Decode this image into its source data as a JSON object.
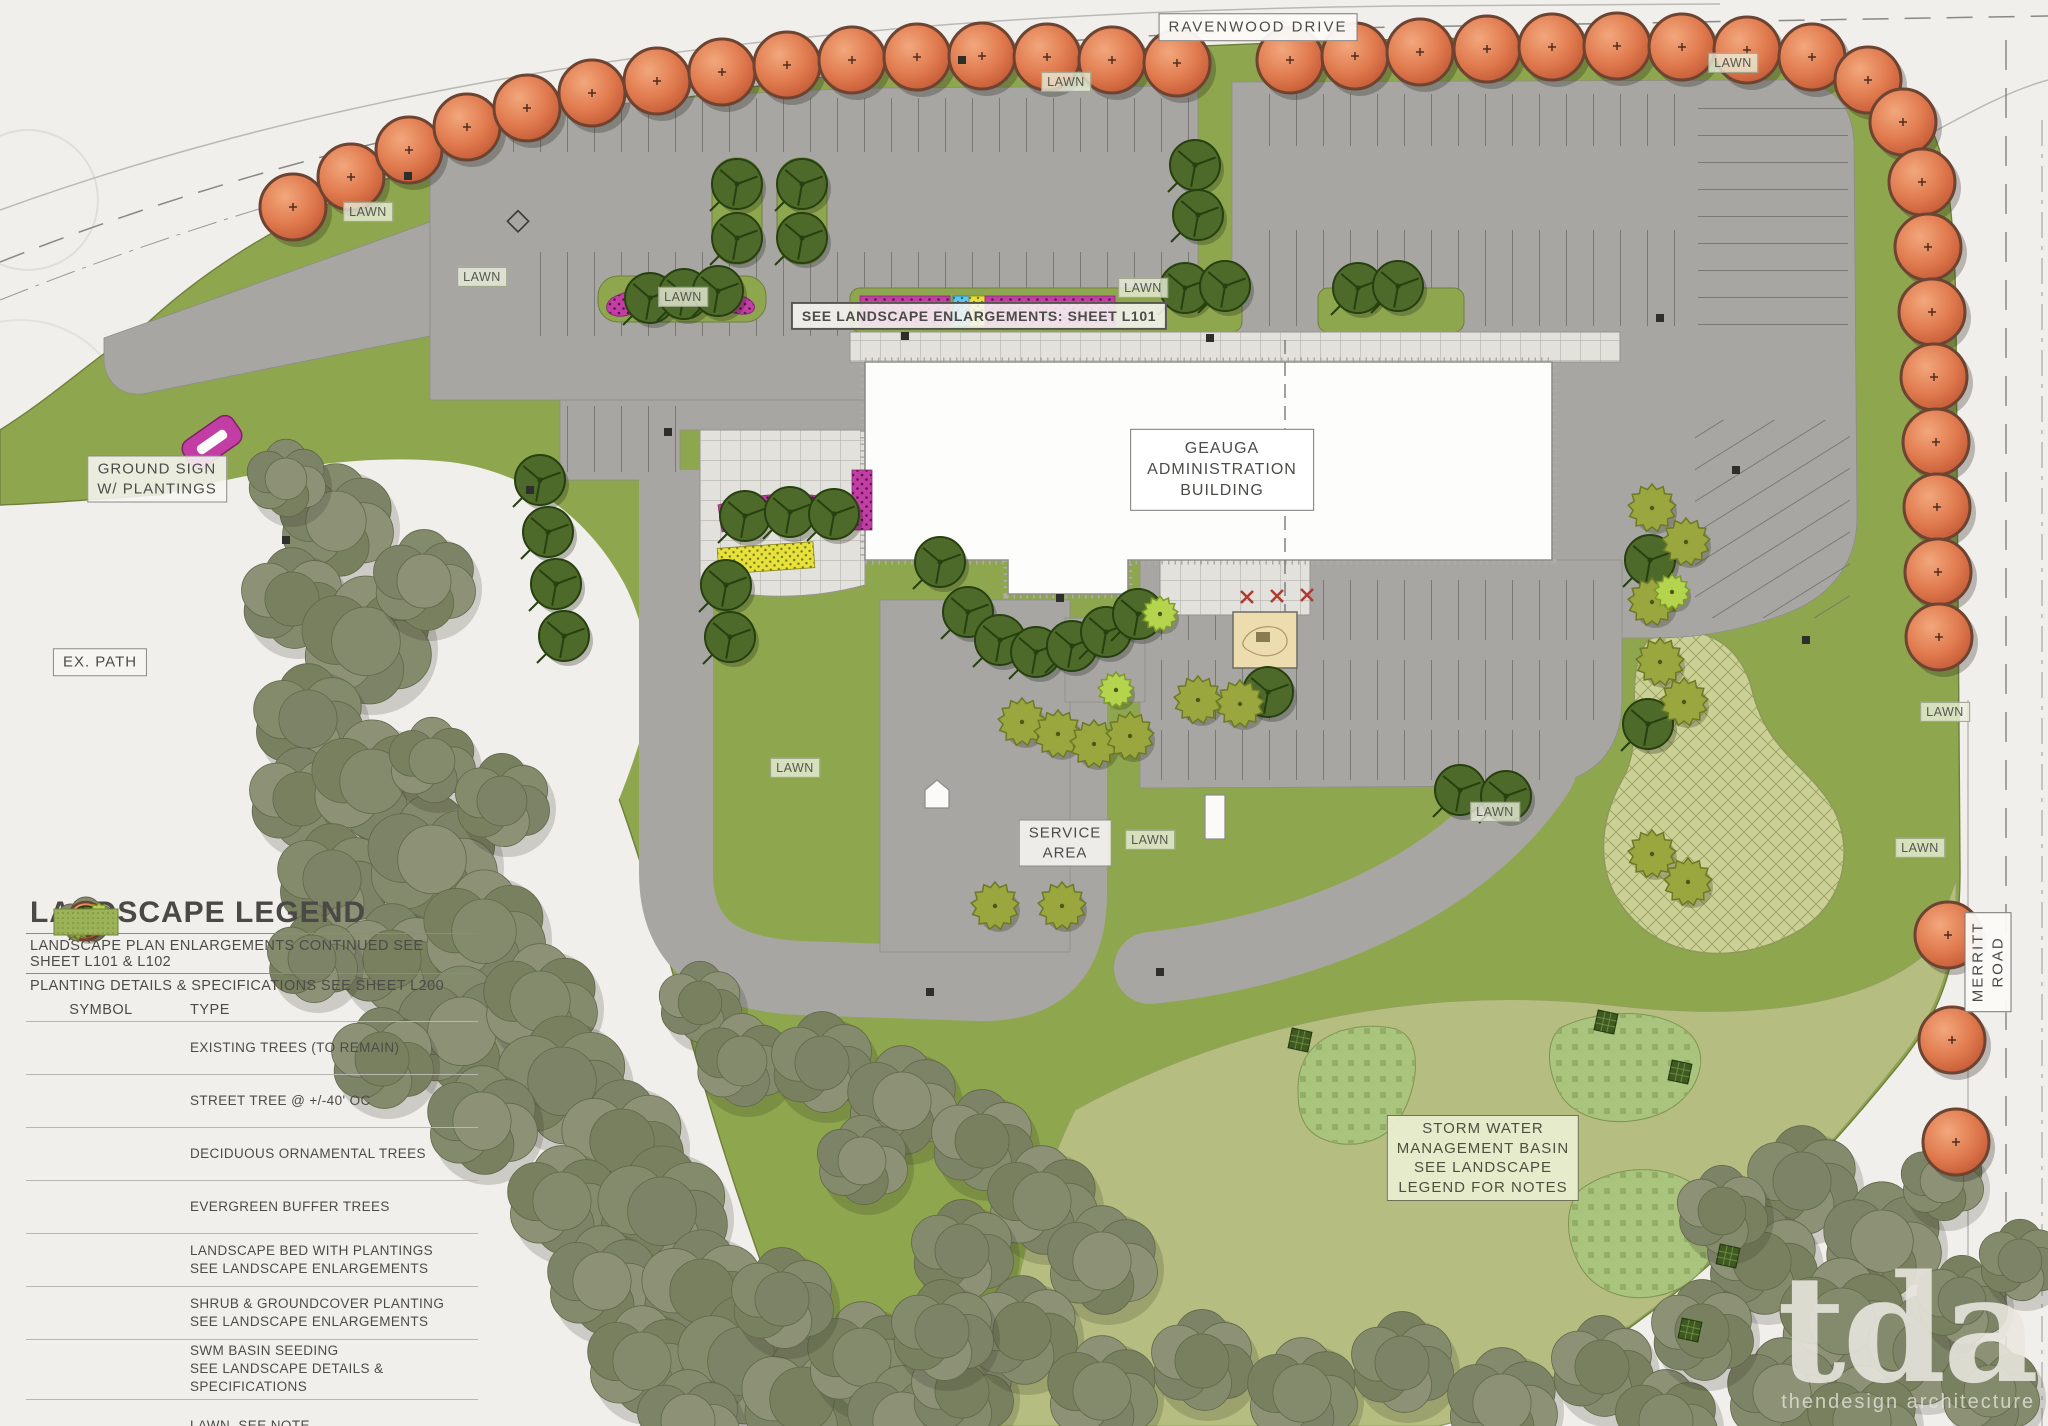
{
  "plan": {
    "roads": {
      "top": "RAVENWOOD DRIVE",
      "right": "MERRITT ROAD"
    },
    "labels": [
      {
        "text": "RAVENWOOD DRIVE",
        "x": 1258,
        "y": 27,
        "cls": "road"
      },
      {
        "text": "MERRITT ROAD",
        "x": 1988,
        "y": 962,
        "cls": "road",
        "rot": -90
      },
      {
        "text": "GROUND SIGN\nW/ PLANTINGS",
        "x": 157,
        "y": 479,
        "cls": ""
      },
      {
        "text": "EX. PATH",
        "x": 100,
        "y": 662,
        "cls": ""
      },
      {
        "text": "SEE LANDSCAPE ENLARGEMENTS: SHEET L101",
        "x": 979,
        "y": 316,
        "cls": "strong"
      },
      {
        "text": "GEAUGA\nADMINISTRATION\nBUILDING",
        "x": 1222,
        "y": 470,
        "cls": "bldg"
      },
      {
        "text": "SERVICE\nAREA",
        "x": 1065,
        "y": 843,
        "cls": ""
      },
      {
        "text": "STORM WATER\nMANAGEMENT BASIN\nSEE LANDSCAPE\nLEGEND FOR NOTES",
        "x": 1483,
        "y": 1158,
        "cls": "green"
      },
      {
        "text": "LAWN",
        "x": 368,
        "y": 212,
        "cls": "lawn"
      },
      {
        "text": "LAWN",
        "x": 482,
        "y": 277,
        "cls": "lawn"
      },
      {
        "text": "LAWN",
        "x": 683,
        "y": 297,
        "cls": "lawn"
      },
      {
        "text": "LAWN",
        "x": 1066,
        "y": 82,
        "cls": "lawn"
      },
      {
        "text": "LAWN",
        "x": 1143,
        "y": 288,
        "cls": "lawn"
      },
      {
        "text": "LAWN",
        "x": 1733,
        "y": 63,
        "cls": "lawn"
      },
      {
        "text": "LAWN",
        "x": 1495,
        "y": 812,
        "cls": "lawn"
      },
      {
        "text": "LAWN",
        "x": 1150,
        "y": 840,
        "cls": "lawn"
      },
      {
        "text": "LAWN",
        "x": 795,
        "y": 768,
        "cls": "lawn"
      },
      {
        "text": "LAWN",
        "x": 1920,
        "y": 848,
        "cls": "lawn"
      },
      {
        "text": "LAWN",
        "x": 1945,
        "y": 712,
        "cls": "lawn"
      }
    ],
    "street_trees": [
      [
        293,
        207
      ],
      [
        351,
        177
      ],
      [
        409,
        150
      ],
      [
        467,
        127
      ],
      [
        527,
        108
      ],
      [
        592,
        93
      ],
      [
        657,
        81
      ],
      [
        722,
        72
      ],
      [
        787,
        65
      ],
      [
        852,
        60
      ],
      [
        917,
        57
      ],
      [
        982,
        56
      ],
      [
        1047,
        57
      ],
      [
        1112,
        60
      ],
      [
        1177,
        63
      ],
      [
        1290,
        60
      ],
      [
        1355,
        56
      ],
      [
        1420,
        52
      ],
      [
        1487,
        49
      ],
      [
        1552,
        47
      ],
      [
        1617,
        46
      ],
      [
        1682,
        47
      ],
      [
        1747,
        50
      ],
      [
        1812,
        57
      ],
      [
        1868,
        80
      ],
      [
        1903,
        122
      ],
      [
        1922,
        182
      ],
      [
        1928,
        247
      ],
      [
        1932,
        312
      ],
      [
        1934,
        377
      ],
      [
        1936,
        442
      ],
      [
        1937,
        507
      ],
      [
        1938,
        572
      ],
      [
        1939,
        637
      ],
      [
        1948,
        935
      ],
      [
        1952,
        1040
      ],
      [
        1956,
        1142
      ]
    ],
    "ornamental_trees": [
      [
        737,
        184
      ],
      [
        737,
        238
      ],
      [
        802,
        184
      ],
      [
        802,
        238
      ],
      [
        650,
        298
      ],
      [
        684,
        294
      ],
      [
        718,
        291
      ],
      [
        1185,
        288
      ],
      [
        1225,
        286
      ],
      [
        1358,
        288
      ],
      [
        1398,
        286
      ],
      [
        1195,
        165
      ],
      [
        1198,
        215
      ],
      [
        745,
        516
      ],
      [
        790,
        512
      ],
      [
        834,
        514
      ],
      [
        540,
        480
      ],
      [
        548,
        532
      ],
      [
        556,
        584
      ],
      [
        564,
        636
      ],
      [
        726,
        585
      ],
      [
        730,
        637
      ],
      [
        940,
        562
      ],
      [
        968,
        612
      ],
      [
        1000,
        640
      ],
      [
        1036,
        652
      ],
      [
        1072,
        646
      ],
      [
        1106,
        632
      ],
      [
        1138,
        614
      ],
      [
        1268,
        692
      ],
      [
        1650,
        560
      ],
      [
        1648,
        724
      ],
      [
        1460,
        790
      ],
      [
        1506,
        796
      ]
    ],
    "evergreen_trees": [
      [
        1022,
        722
      ],
      [
        1058,
        734
      ],
      [
        1094,
        744
      ],
      [
        1130,
        736
      ],
      [
        1198,
        700
      ],
      [
        1240,
        704
      ],
      [
        1652,
        508
      ],
      [
        1686,
        542
      ],
      [
        1652,
        602
      ],
      [
        1660,
        662
      ],
      [
        1684,
        702
      ],
      [
        1652,
        854
      ],
      [
        1688,
        882
      ],
      [
        995,
        906
      ],
      [
        1062,
        906
      ],
      [
        1672,
        592,
        "lime"
      ],
      [
        1160,
        614,
        "lime"
      ],
      [
        1116,
        690,
        "lime"
      ]
    ],
    "existing_tree_clusters": [
      [
        336,
        520,
        58
      ],
      [
        292,
        598,
        52
      ],
      [
        366,
        640,
        66
      ],
      [
        308,
        718,
        56
      ],
      [
        424,
        580,
        52
      ],
      [
        300,
        798,
        52
      ],
      [
        372,
        780,
        62
      ],
      [
        332,
        878,
        56
      ],
      [
        432,
        858,
        66
      ],
      [
        392,
        958,
        56
      ],
      [
        484,
        930,
        62
      ],
      [
        312,
        958,
        46
      ],
      [
        462,
        1030,
        66
      ],
      [
        382,
        1058,
        52
      ],
      [
        540,
        1000,
        58
      ],
      [
        562,
        1080,
        66
      ],
      [
        482,
        1120,
        56
      ],
      [
        622,
        1140,
        62
      ],
      [
        562,
        1200,
        56
      ],
      [
        662,
        1210,
        66
      ],
      [
        602,
        1280,
        56
      ],
      [
        702,
        1290,
        62
      ],
      [
        642,
        1360,
        56
      ],
      [
        742,
        1360,
        66
      ],
      [
        688,
        1420,
        52
      ],
      [
        802,
        1398,
        62
      ],
      [
        862,
        1356,
        56
      ],
      [
        782,
        1298,
        52
      ],
      [
        902,
        1420,
        56
      ],
      [
        962,
        1390,
        52
      ],
      [
        432,
        760,
        44
      ],
      [
        502,
        800,
        48
      ],
      [
        286,
        478,
        40
      ],
      [
        700,
        1002,
        42
      ],
      [
        742,
        1060,
        48
      ],
      [
        822,
        1062,
        52
      ],
      [
        902,
        1100,
        56
      ],
      [
        982,
        1140,
        52
      ],
      [
        1042,
        1200,
        56
      ],
      [
        962,
        1250,
        52
      ],
      [
        1102,
        1260,
        56
      ],
      [
        1022,
        1330,
        56
      ],
      [
        1102,
        1390,
        56
      ],
      [
        942,
        1330,
        52
      ],
      [
        862,
        1160,
        46
      ],
      [
        1202,
        1360,
        52
      ],
      [
        1302,
        1392,
        56
      ],
      [
        1402,
        1362,
        52
      ],
      [
        1502,
        1402,
        56
      ],
      [
        1602,
        1366,
        52
      ],
      [
        1666,
        1420,
        52
      ],
      [
        1802,
        1180,
        56
      ],
      [
        1882,
        1240,
        60
      ],
      [
        1762,
        1260,
        56
      ],
      [
        1842,
        1320,
        64
      ],
      [
        1922,
        1350,
        56
      ],
      [
        1782,
        1392,
        56
      ],
      [
        1702,
        1330,
        52
      ],
      [
        1862,
        1420,
        56
      ],
      [
        1962,
        1300,
        46
      ],
      [
        1942,
        1180,
        42
      ],
      [
        1722,
        1210,
        46
      ],
      [
        1990,
        1390,
        50
      ],
      [
        2020,
        1260,
        42
      ]
    ],
    "swm_markers": [
      [
        1300,
        1040
      ],
      [
        1606,
        1022
      ],
      [
        1680,
        1072
      ],
      [
        1728,
        1256
      ],
      [
        1690,
        1330
      ]
    ],
    "site_lights": [
      [
        530,
        490
      ],
      [
        668,
        432
      ],
      [
        905,
        336
      ],
      [
        1046,
        316
      ],
      [
        1210,
        338
      ],
      [
        1660,
        318
      ],
      [
        1736,
        470
      ],
      [
        1060,
        598
      ],
      [
        930,
        992
      ],
      [
        1160,
        972
      ],
      [
        1806,
        640
      ],
      [
        408,
        176
      ],
      [
        286,
        540
      ],
      [
        962,
        60
      ]
    ],
    "colors": {
      "paper": "#f1efec",
      "lawn": "#8ea74e",
      "lawn_edge": "#6f7f3b",
      "parking": "#a7a6a3",
      "basin": "#b6bd80",
      "basin_patch": "#a9c47d",
      "street_tree": "#da6b42",
      "street_tree_rim": "#6d4331",
      "ornamental": "#4e6a2a",
      "evergreen": "#9aa73e",
      "evergreen_lime": "#b5d44e",
      "existing": "#848a6c",
      "bed_magenta": "#c23ea5",
      "bed_yellow": "#e6e23b",
      "bed_blue": "#5fc6ee"
    }
  },
  "legend": {
    "title": "LANDSCAPE LEGEND",
    "notes": [
      "LANDSCAPE PLAN ENLARGEMENTS CONTINUED SEE SHEET L101 & L102",
      "PLANTING DETAILS & SPECIFICATIONS SEE SHEET L200"
    ],
    "headers": [
      "SYMBOL",
      "TYPE"
    ],
    "items": [
      {
        "sym": "existing",
        "label": "EXISTING TREES (TO REMAIN)"
      },
      {
        "sym": "street",
        "label": "STREET TREE @ +/-40' OC"
      },
      {
        "sym": "deciduous",
        "label": "DECIDUOUS ORNAMENTAL TREES"
      },
      {
        "sym": "evergreen",
        "label": "EVERGREEN BUFFER TREES"
      },
      {
        "sym": "bed",
        "label": "LANDSCAPE BED WITH PLANTINGS\nSEE LANDSCAPE ENLARGEMENTS"
      },
      {
        "sym": "shrub",
        "label": "SHRUB & GROUNDCOVER PLANTING\nSEE LANDSCAPE ENLARGEMENTS"
      },
      {
        "sym": "swm",
        "label": "SWM BASIN SEEDING\nSEE LANDSCAPE DETAILS & SPECIFICATIONS"
      },
      {
        "sym": "lawn",
        "label": "LAWN, SEE NOTE"
      }
    ]
  },
  "logo": {
    "text": "tda",
    "tagline": "thendesign architecture"
  }
}
